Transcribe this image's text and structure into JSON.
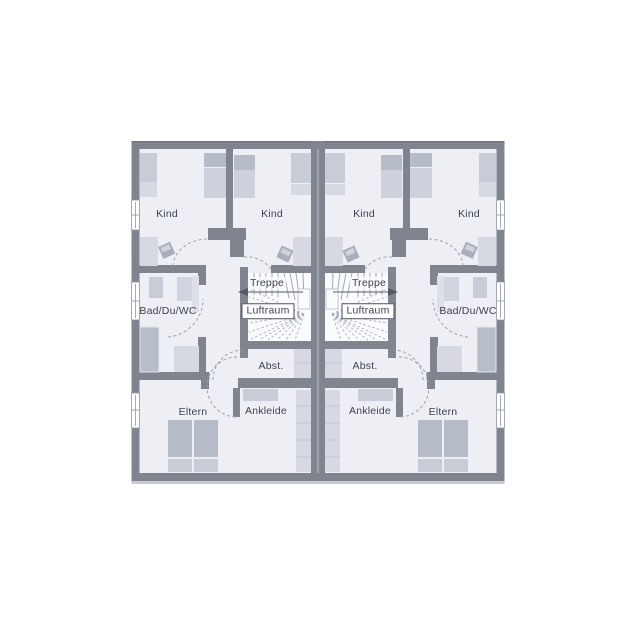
{
  "document": {
    "type": "floor-plan",
    "description": "Upper floor plan of a mirrored semi-detached (duplex) house, two identical units"
  },
  "left_unit": {
    "kind_outer": "Kind",
    "kind_inner": "Kind",
    "bathroom": "Bad/Du/WC",
    "stairs": "Treppe",
    "air_space": "Luftraum",
    "storage": "Abst.",
    "dressing": "Ankleide",
    "parents": "Eltern"
  },
  "right_unit": {
    "kind_outer": "Kind",
    "kind_inner": "Kind",
    "bathroom": "Bad/Du/WC",
    "stairs": "Treppe",
    "air_space": "Luftraum",
    "storage": "Abst.",
    "dressing": "Ankleide",
    "parents": "Eltern"
  },
  "colors": {
    "wall": "#7f848f",
    "floor": "#edeff4",
    "stair_background": "#fafbfe",
    "furniture_light": "#d6d9e2",
    "furniture_medium": "#c8ccd7",
    "furniture_dark": "#b5bbc7",
    "label_text": "#3f434e"
  }
}
